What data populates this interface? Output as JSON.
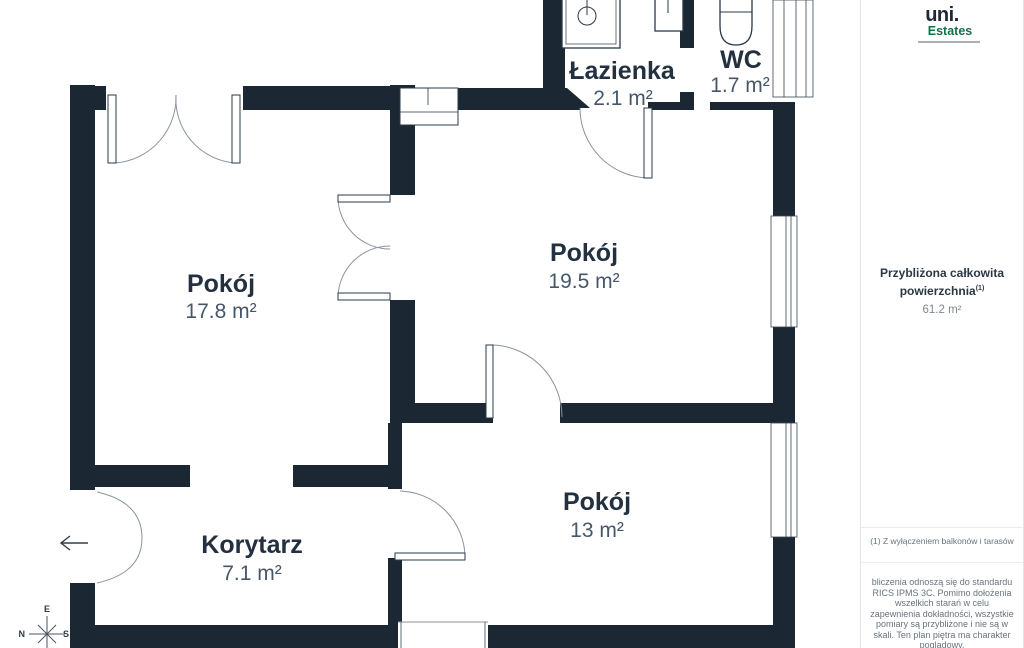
{
  "branding": {
    "logo_primary": "uni.",
    "logo_secondary": "Estates"
  },
  "summary": {
    "title_line1": "Przybliżona całkowita",
    "title_line2": "powierzchnia",
    "superscript": "(1)",
    "value": "61.2 m²"
  },
  "footnote": {
    "text": "(1) Z wyłączeniem balkonów i tarasów"
  },
  "disclaimer": {
    "text": "bliczenia odnoszą się do standardu RICS IPMS 3C. Pomimo dołożenia wszelkich starań w celu zapewnienia dokładności, wszystkie pomiary są przybliżone i nie są w skali. Ten plan piętra ma charakter poglądowy."
  },
  "compass": {
    "e": "E",
    "n": "N",
    "s": "S"
  },
  "rooms": [
    {
      "name": "Pokój",
      "area": "17.8 m²"
    },
    {
      "name": "Pokój",
      "area": "19.5 m²"
    },
    {
      "name": "Pokój",
      "area": "13 m²"
    },
    {
      "name": "Korytarz",
      "area": "7.1 m²"
    },
    {
      "name": "Łazienka",
      "area": "2.1 m²"
    },
    {
      "name": "WC",
      "area": "1.7 m²"
    }
  ],
  "colors": {
    "wall": "#1c2734",
    "accent_green": "#12724a",
    "room_label": "#22303f",
    "area_label": "#47576a",
    "muted_text": "#68737e"
  }
}
